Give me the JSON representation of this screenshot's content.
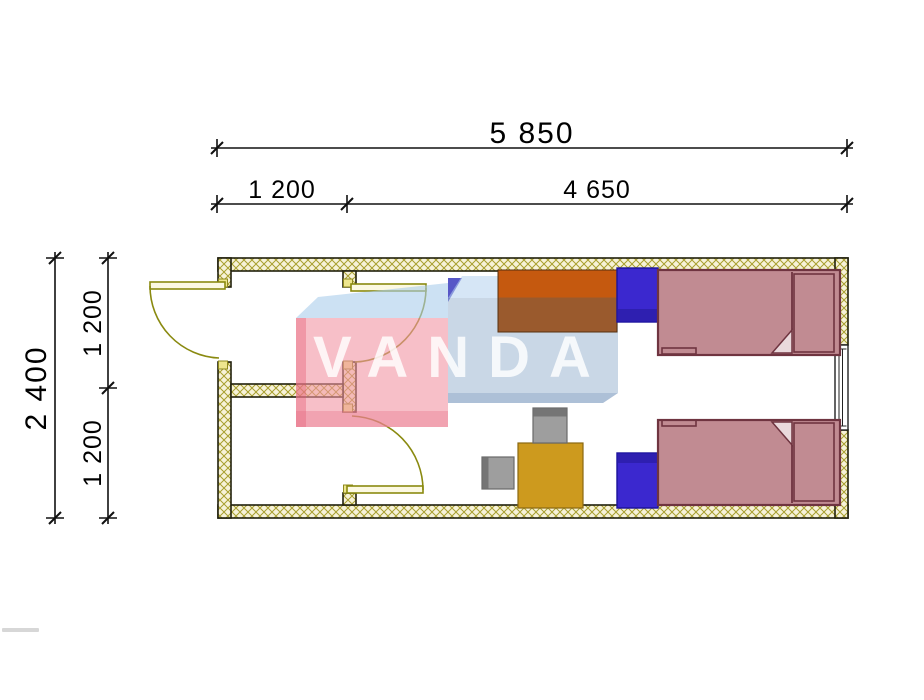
{
  "dimensions": {
    "top_overall": "5 850",
    "top_left_segment": "1 200",
    "top_right_segment": "4 650",
    "side_overall": "2 400",
    "side_upper_segment": "1 200",
    "side_lower_segment": "1 200"
  },
  "watermark": {
    "text": "VANDA"
  },
  "furniture_counts": {
    "beds": 2,
    "nightstands": 2,
    "desks": 1,
    "tables": 1,
    "chairs": 2
  },
  "colors": {
    "bed_fill": "#c18b92",
    "bed_outline": "#6f3440",
    "bed_fold": "#ead9dc",
    "nightstand_fill": "#3b28cf",
    "nightstand_shade": "#2e1fb0",
    "desk_top": "#c5590f",
    "desk_body": "#9a5a2d",
    "table_fill": "#cd9a1e",
    "chair_fill": "#9e9e9e",
    "chair_shade": "#757575",
    "wall_hatch_bg": "#f7f2d8",
    "wall_hatch_line": "#a89f2e",
    "door_line": "#8a8a10",
    "dim_line": "#111111",
    "watermark_pink": "#f2a9b8",
    "watermark_blue_light": "#ccdcec",
    "watermark_blue_dark": "#2c2cb8",
    "watermark_text": "#ffffff"
  }
}
